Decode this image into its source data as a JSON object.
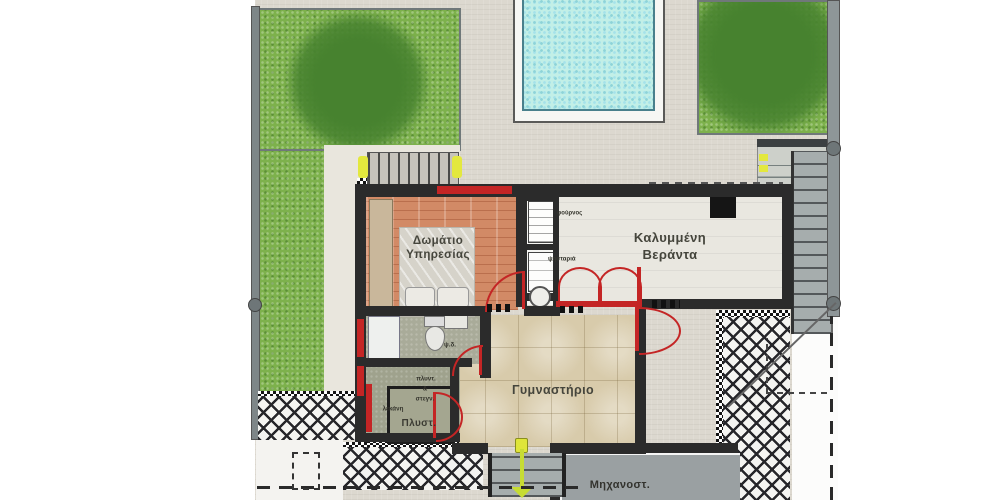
{
  "plan_title": "villa-ground-floor-plan",
  "rooms": {
    "service_room_line1": "Δωμάτιο",
    "service_room_line2": "Υπηρεσίας",
    "veranda_line1": "Καλυμμένη",
    "veranda_line2": "Βεράντα",
    "gym": "Γυμναστήριο",
    "laundry": "Πλυστ.",
    "machine_room": "Μηχανοστ."
  },
  "fixtures": {
    "oven": "φούρνος",
    "grill": "ψησταριά",
    "washer": "πλυντ.",
    "ampersand": "&",
    "dryer": "στεγν.",
    "basin": "λεκάνη",
    "wc": "ψ.δ."
  },
  "colors": {
    "wall": "#2b2b2b",
    "door_window_red": "#c42525",
    "highlight_yellow": "#dfe53a",
    "grass": "#7db14c",
    "tree_canopy": "#47822f",
    "pool_water": "#c2efe7",
    "concrete": "#dcd8cf",
    "wood_floor": "#d28a66",
    "gym_tile": "#d8cbab",
    "machine_floor": "#9aa0a2"
  }
}
